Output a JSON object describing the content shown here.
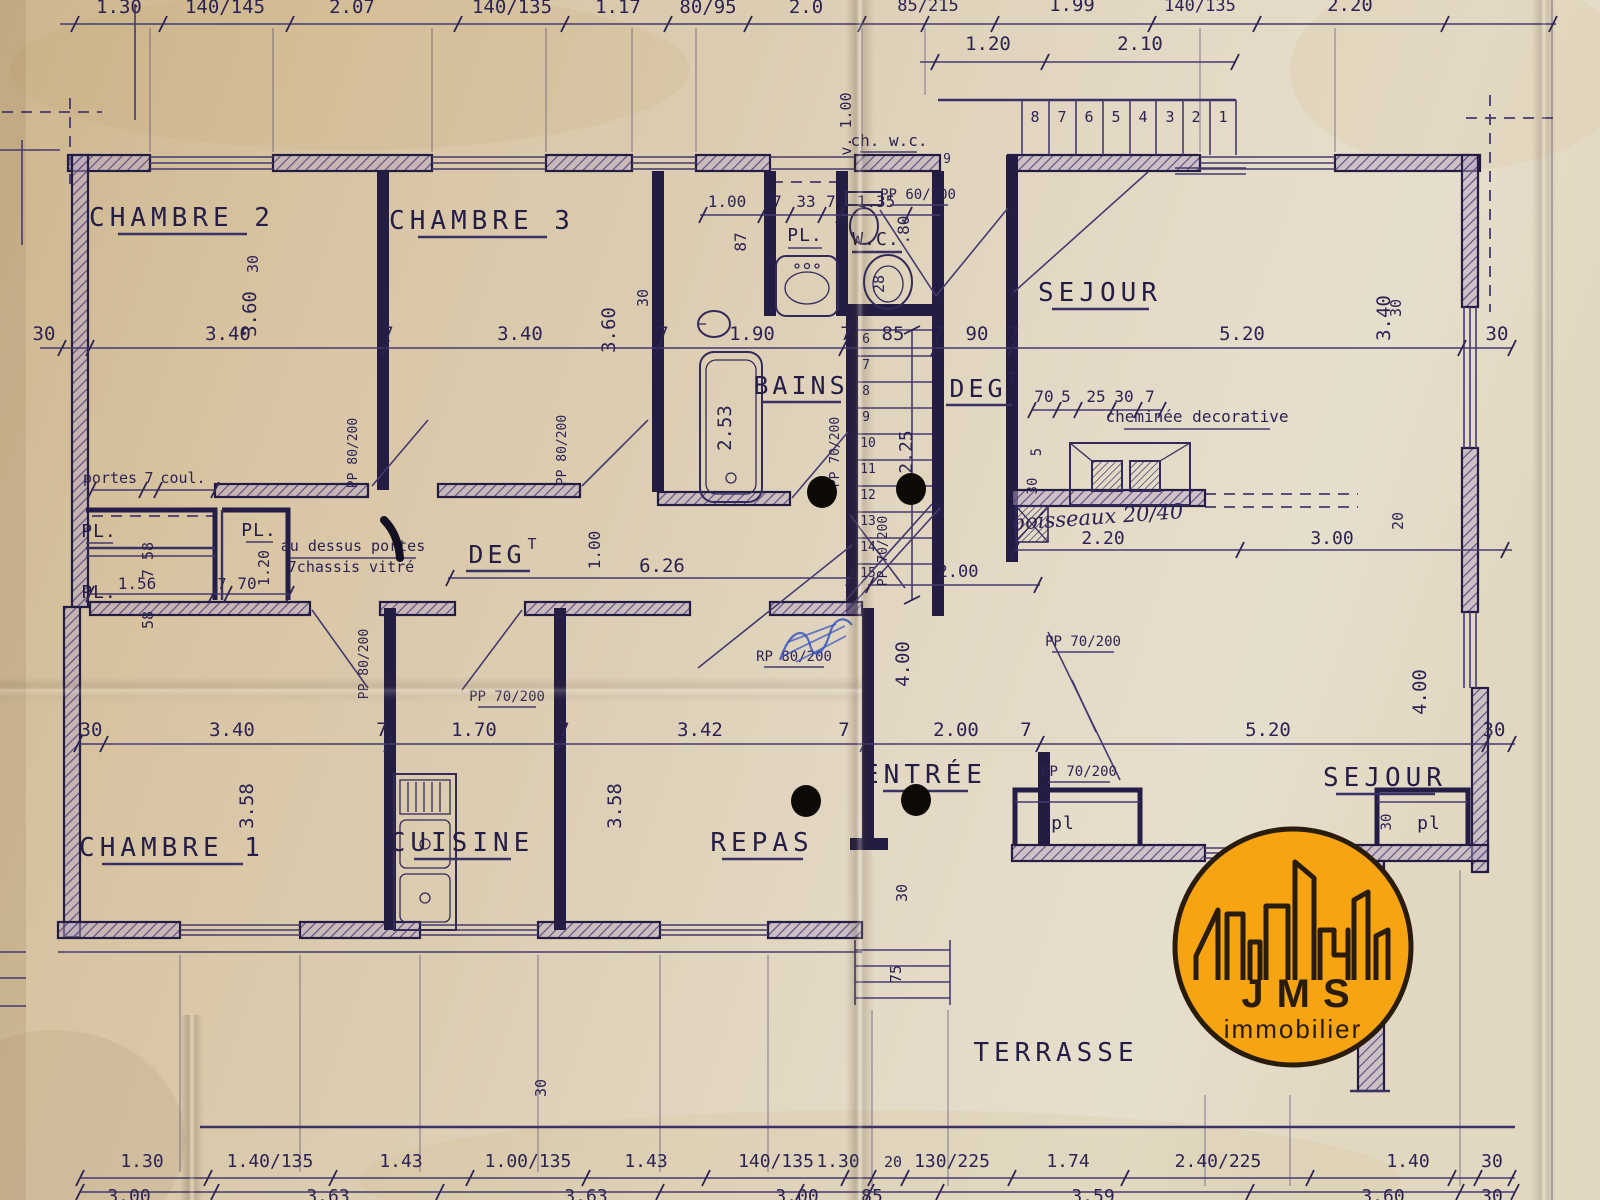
{
  "palette": {
    "paper": "#dccdb2",
    "ink": "#2c2353",
    "wall": "#231c43",
    "pen_blue": "#3a55c0",
    "logo_orange": "#F7A412",
    "logo_ink": "#2a1c0c",
    "punch_hole": "#0d0a07"
  },
  "rooms": {
    "chambre1": "CHAMBRE 1",
    "chambre2": "CHAMBRE 2",
    "chambre3": "CHAMBRE 3",
    "cuisine": "CUISINE",
    "repas": "REPAS",
    "entree": "ENTRÉE",
    "sejour_haut": "SEJOUR",
    "sejour_bas": "SEJOUR",
    "bains": "BAINS",
    "wc": "W.C.",
    "deg_gauche": "DEG",
    "deg_centre": "DEG",
    "deg_sup": "T",
    "terrasse": "TERRASSE",
    "pl_haut": "PL.",
    "pl_gauche_1": "PL.",
    "pl_gauche_2": "PL.",
    "pl_milieu": "PL.",
    "placard_gauche": "pl",
    "placard_droit": "pl"
  },
  "notes": {
    "portes": "portes",
    "portes_ep": "7",
    "coul": "coul.",
    "au_dessus": "au dessus portes",
    "chassis": "7chassis vitré",
    "cheminee": "cheminée decorative",
    "boisseaux": "boisseaux 20/40",
    "ch_wc": "ch. w.c.",
    "v_un": "v. 1.00"
  },
  "portes_labels": {
    "ch2": "PP 80/200",
    "ch3": "PP 80/200",
    "bains": "PP 70/200",
    "wc": "PP 60/200",
    "escalier": "PP 70/200",
    "ch1": "PP 80/200",
    "cuisine": "PP 70/200",
    "repas": "RP 80/200",
    "sejour_a": "PP 70/200",
    "sejour_b": "PP 70/200"
  },
  "dims": {
    "top1": [
      "1.30",
      "140/145",
      "2.07",
      "140/135",
      "1.17",
      "80/95",
      "2.0",
      "85/215",
      "1.99",
      "140/135",
      "2.20"
    ],
    "top2": [
      "1.20",
      "2.10"
    ],
    "marches_haut": [
      "8",
      "7",
      "6",
      "5",
      "4",
      "3",
      "2",
      "1"
    ],
    "marche_9": "9",
    "marches_esc": [
      "6",
      "7",
      "8",
      "9",
      "10",
      "11",
      "12",
      "13",
      "14",
      "15"
    ],
    "ligne_haut": [
      "30",
      "3.40",
      "7",
      "3.40",
      "7",
      "1.90",
      "7",
      "85",
      "7",
      "90",
      "7",
      "5.20",
      "30"
    ],
    "ligne_bas": [
      "30",
      "3.40",
      "7",
      "1.70",
      "7",
      "3.42",
      "7",
      "2.00",
      "7",
      "5.20",
      "30"
    ],
    "rang_pl": [
      "1.00",
      "7",
      "33",
      "7",
      "1.35"
    ],
    "rang_cheminee": [
      "70",
      "5",
      "25",
      "30",
      "7"
    ],
    "bas1": [
      "1.30",
      "1.40/135",
      "1.43",
      "1.00/135",
      "1.43",
      "140/135",
      "1.30",
      "20",
      "130/225",
      "1.74",
      "2.40/225",
      "1.40",
      "30"
    ],
    "bas2": [
      "3.00",
      "3.63",
      "3.63",
      "3.00",
      "85",
      "3.59",
      "3.60",
      "30"
    ],
    "vert": {
      "a": "3.60",
      "b": "3.60",
      "c": "3.40",
      "d": "2.53",
      "e": "2.25",
      "f": "3.58",
      "g": "3.58",
      "h": "4.00",
      "i": "4.00",
      "j": "87",
      "k": ".80",
      "l": "28",
      "m": "7 58",
      "n": "58",
      "o": "1.20",
      "p": "1.00",
      "q": "20",
      "r": "5",
      "s": "30",
      "t": "30",
      "u": "30",
      "v": "30",
      "w": "30",
      "x": "75",
      "y": "30",
      "z": "30"
    },
    "divers": {
      "a": "6.26",
      "b": "1.56",
      "c": "7",
      "d": "70",
      "e": "2.00",
      "f": "2.20",
      "g": "3.00"
    }
  },
  "logo": {
    "sigle": "JMS",
    "sous_titre": "immobilier"
  }
}
